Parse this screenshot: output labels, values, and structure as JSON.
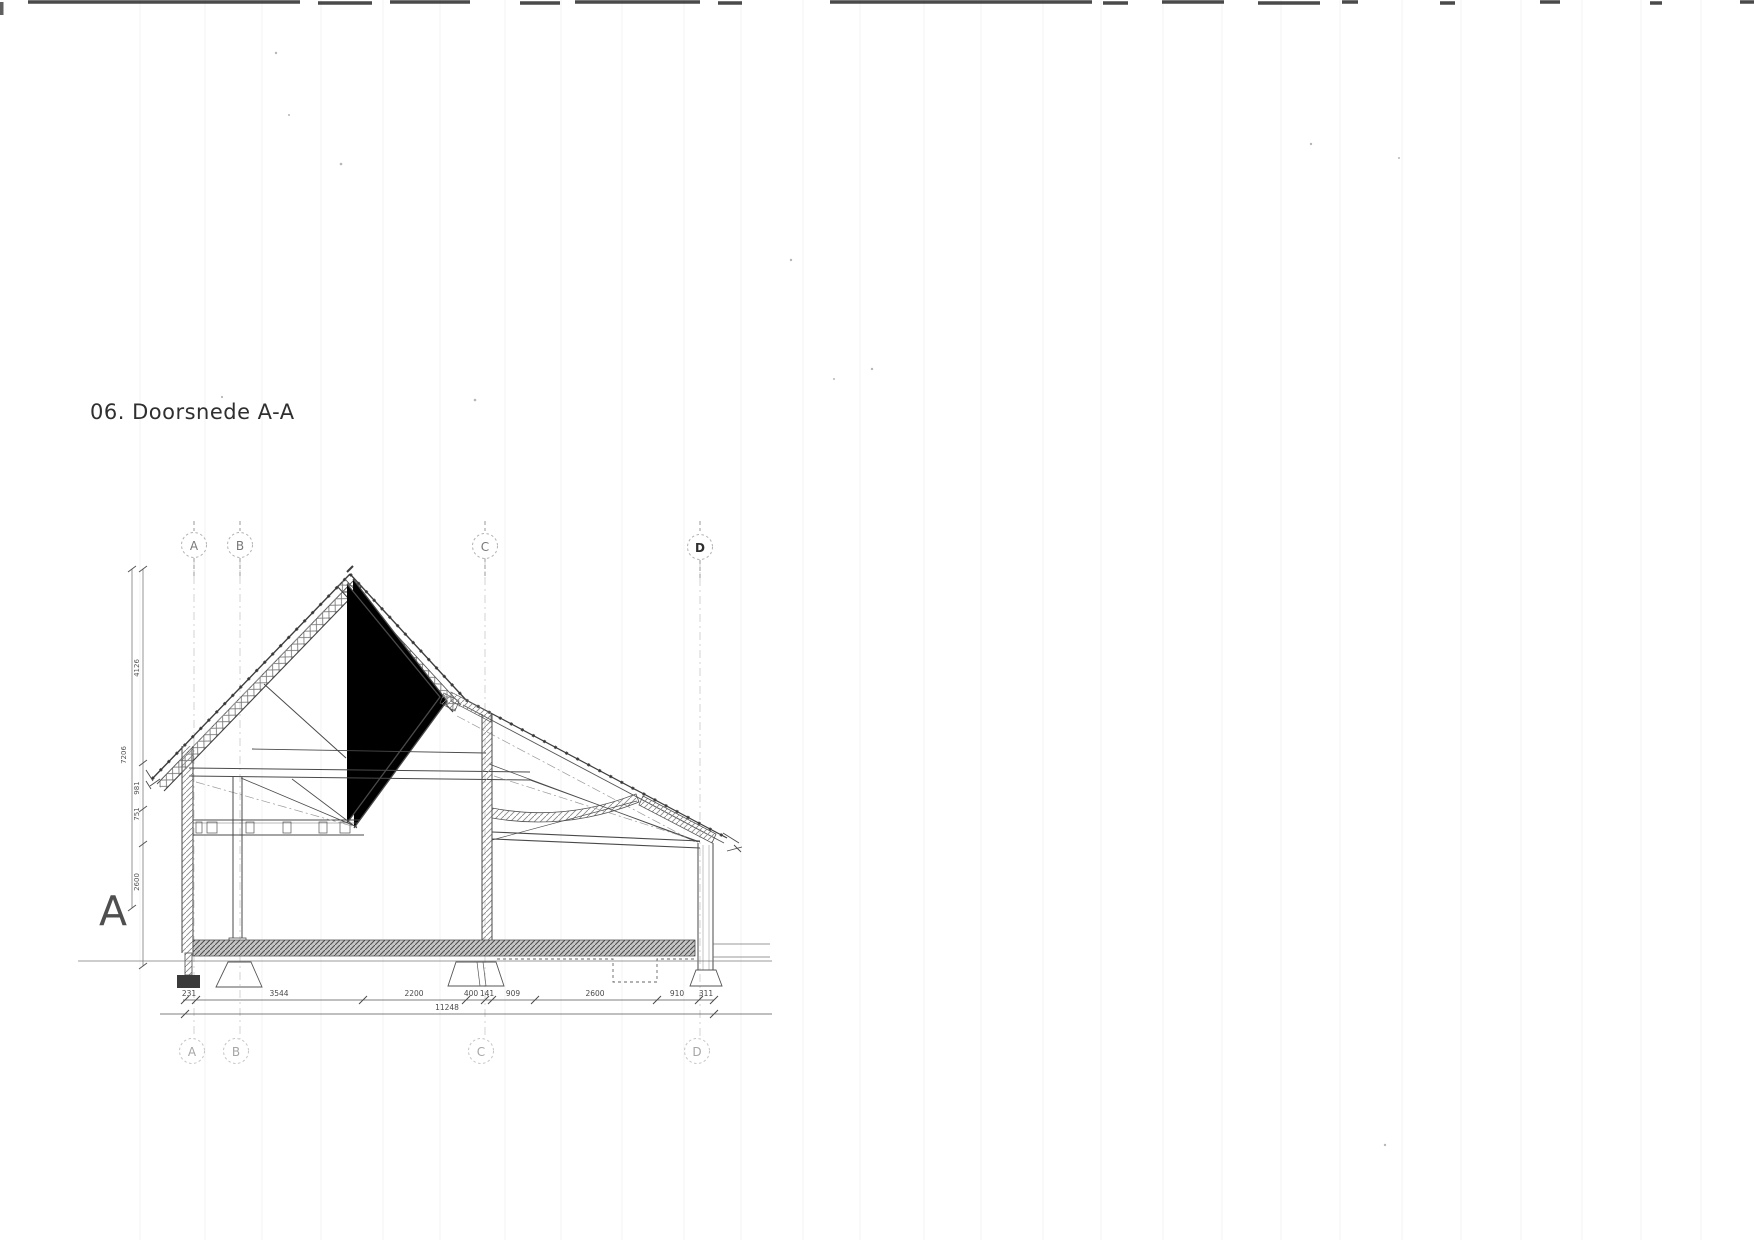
{
  "page": {
    "title": "06. Doorsnede A-A"
  },
  "drawing": {
    "section_marker": "A",
    "grid_top": [
      "A",
      "B",
      "C",
      "D"
    ],
    "grid_bottom": [
      "A",
      "B",
      "C",
      "D"
    ],
    "dim_h": [
      "231",
      "3544",
      "2200",
      "400",
      "141",
      "909",
      "2600",
      "910",
      "311"
    ],
    "dim_h_total": "11248",
    "dim_v": [
      "4126",
      "7206",
      "981",
      "751",
      "2600"
    ]
  },
  "colors": {
    "paper": "#ffffff",
    "ink": "#3f3f3f",
    "grid_faint": "#c9c9c9",
    "dimension_text": "#4a4a4a"
  }
}
